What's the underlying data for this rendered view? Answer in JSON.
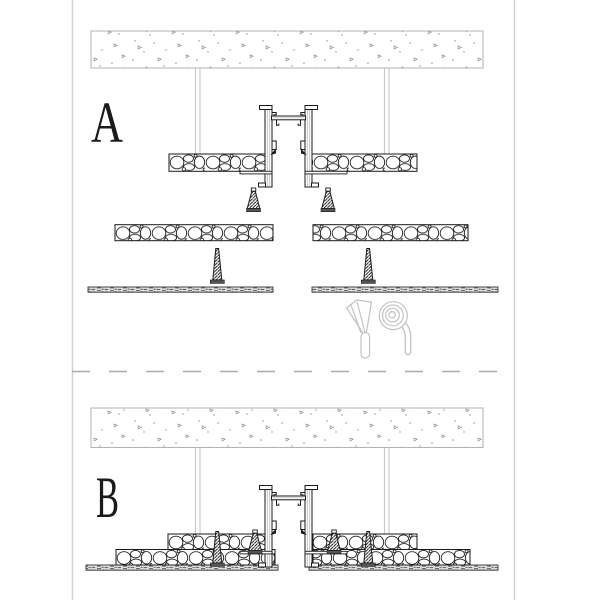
{
  "drawing": {
    "detail_a": {
      "label": "A"
    },
    "detail_b": {
      "label": "B"
    }
  },
  "icons": [
    {
      "name": "trowel-icon"
    },
    {
      "name": "fixing-clip-icon"
    }
  ],
  "palette": {
    "line": "#1a1a1a",
    "slab_outline": "#b3b3b3",
    "concrete_speckle": "#8f8f8f",
    "hanger_rod": "#c8c8c8",
    "tool_outline": "#c3c3c3",
    "separator_dash": "#ababab",
    "sheet_border": "#d2d2d2",
    "screw_base": "#555555",
    "board_hatch_line": "#222222",
    "finish_board_fill": "#e3e3e3"
  }
}
